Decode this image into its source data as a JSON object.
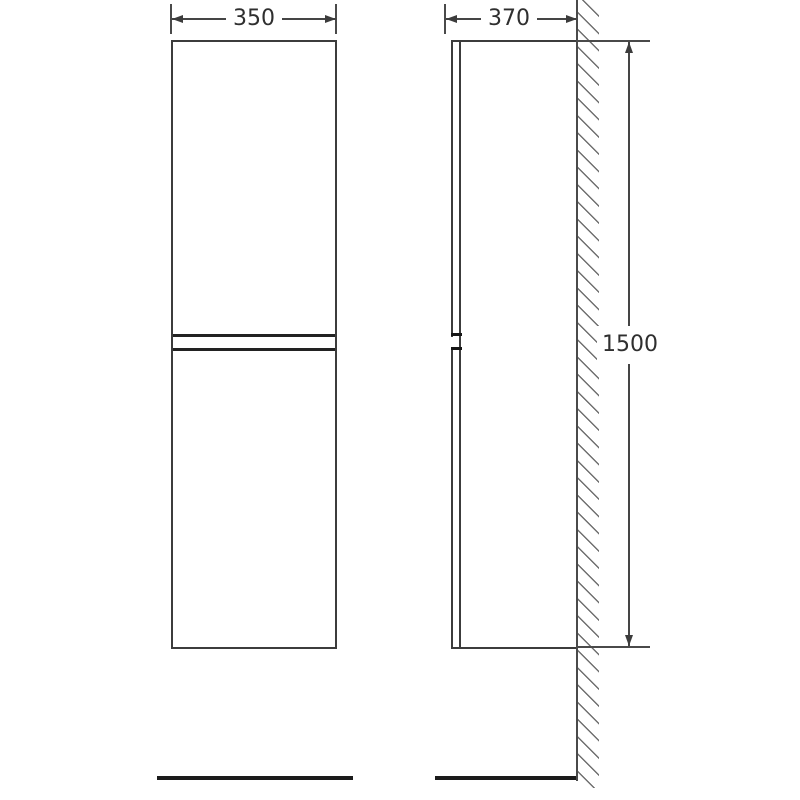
{
  "drawing": {
    "background_color": "#ffffff",
    "outline_color": "#3c3c3c",
    "hatch_color": "#6f6f6f",
    "text_color": "#2f2f2f",
    "views": {
      "front": {
        "width_dimension": "350"
      },
      "side": {
        "depth_dimension": "370",
        "height_dimension": "1500"
      }
    }
  }
}
